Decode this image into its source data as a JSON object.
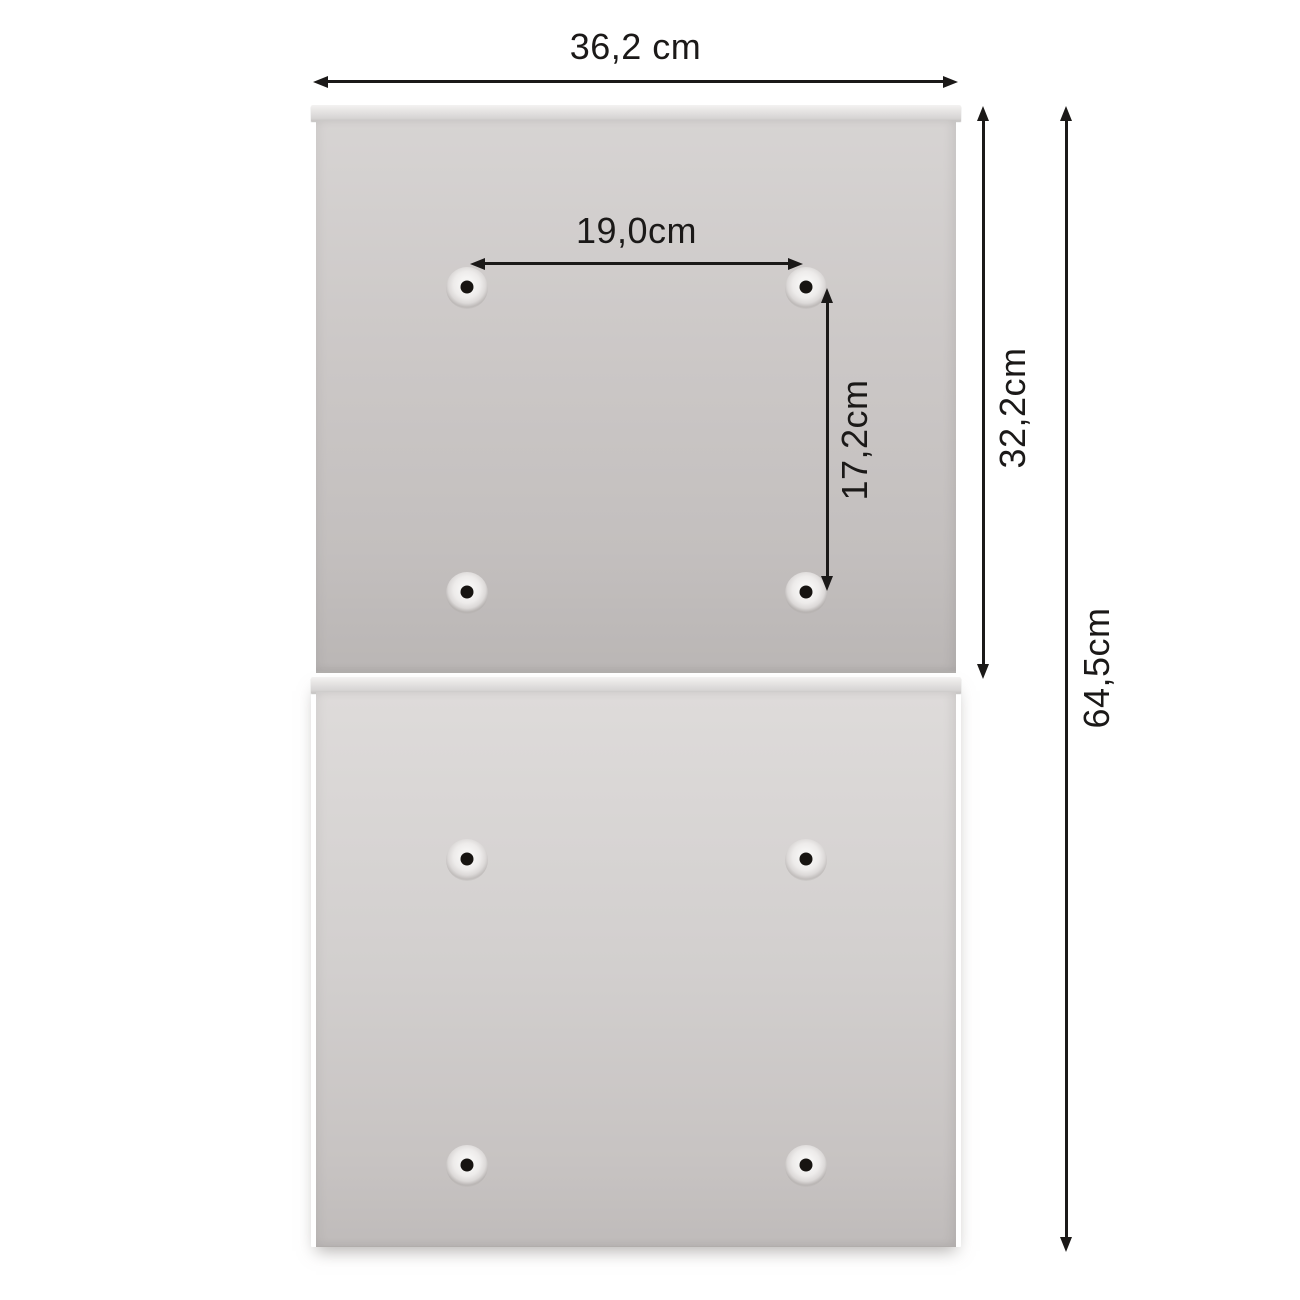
{
  "colors": {
    "background": "#ffffff",
    "dimension_ink": "#1b1918",
    "hole_dot": "#171411",
    "hole_dimple": "#f5f4f3"
  },
  "dimensions": {
    "overall_width": {
      "label": "36,2 cm",
      "value_cm": 36.2
    },
    "hole_spacing_horizontal": {
      "label": "19,0cm",
      "value_cm": 19.0
    },
    "hole_spacing_vertical": {
      "label": "17,2cm",
      "value_cm": 17.2
    },
    "upper_panel_height": {
      "label": "32,2cm",
      "value_cm": 32.2
    },
    "total_height": {
      "label": "64,5cm",
      "value_cm": 64.5
    }
  },
  "panels": [
    {
      "name": "upper back panel",
      "mounting_holes": 4
    },
    {
      "name": "lower back panel",
      "mounting_holes": 4
    }
  ],
  "units": "cm"
}
